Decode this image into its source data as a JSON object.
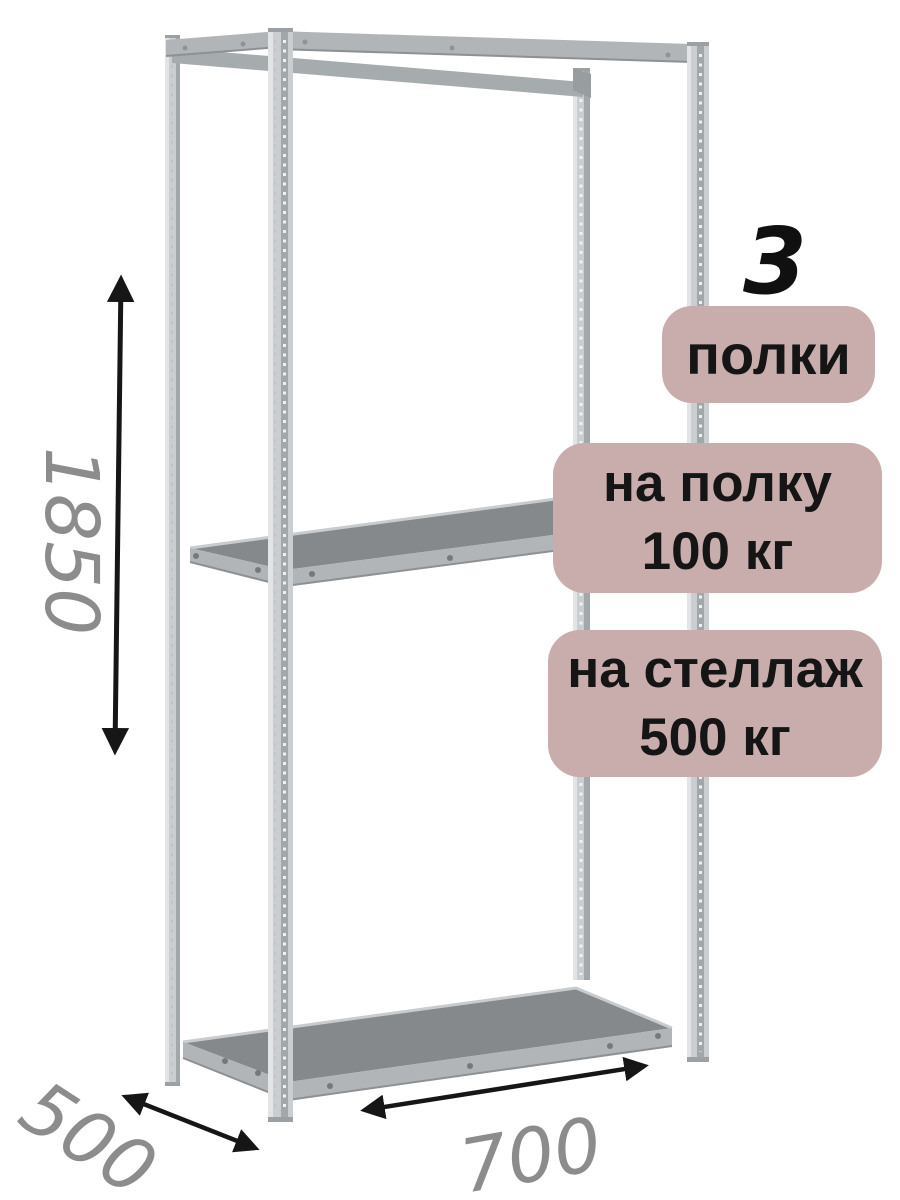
{
  "annotations": {
    "shelf_count_number": "3",
    "shelf_count_label": "полки",
    "shelf_load_line1": "на полку",
    "shelf_load_line2": "100 кг",
    "rack_load_line1": "на стеллаж",
    "rack_load_line2": "500 кг"
  },
  "dimensions": {
    "height": "1850",
    "depth": "500",
    "width": "700"
  },
  "icons": {
    "height_arrow": "double-headed-vertical-arrow",
    "depth_arrow": "double-headed-diagonal-arrow",
    "width_arrow": "double-headed-diagonal-arrow"
  },
  "colors": {
    "badge-bg": "#c9acac",
    "badge-text": "#151515",
    "dimension-text": "#8c8c8c",
    "arrow": "#161616",
    "metal-light": "#cbced0",
    "metal-mid": "#b2b5b7",
    "metal-dark": "#a2a7aa",
    "shelf-top": "#85898c",
    "background": "#ffffff"
  }
}
